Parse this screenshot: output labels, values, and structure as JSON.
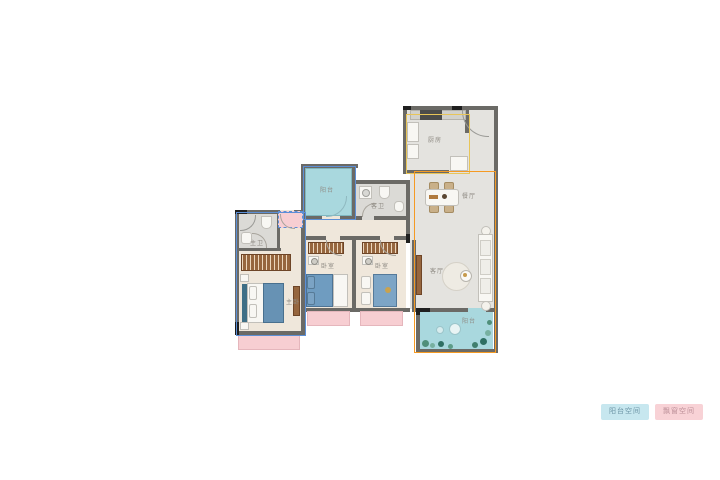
{
  "rooms": {
    "kitchen": {
      "label": "厨房"
    },
    "dining": {
      "label": "餐厅"
    },
    "living": {
      "label": "客厅"
    },
    "balcony_north": {
      "label": "阳台"
    },
    "balcony_south": {
      "label": "阳台"
    },
    "guest_bath": {
      "label": "客卫"
    },
    "master_bath": {
      "label": "主卫"
    },
    "master_bedroom": {
      "label": "主卧"
    },
    "bedroom_a": {
      "label": "卧室"
    },
    "bedroom_b": {
      "label": "卧室"
    }
  },
  "legend": {
    "balcony": {
      "label": "阳台空间"
    },
    "bay": {
      "label": "飘窗空间"
    }
  },
  "colors": {
    "wall": "#6b6a66",
    "wallDark": "#1f1f1f",
    "floorWarm": "#efe7db",
    "floorGray": "#e4e3df",
    "floorTile": "#dbdad6",
    "balcony": "#a9d8de",
    "bay": "#f7ced2",
    "bayBorder": "#e5b6bc",
    "blue": "#5c8fd6",
    "orange": "#f59a23",
    "yellow": "#e8c558",
    "wood": "#96663e",
    "bedBlue": "#6792b4",
    "labelColor": "#8f8b84",
    "legendBlueBg": "#c7e7ef",
    "legendBlueText": "#6b93a4",
    "legendPinkBg": "#f8d2d6",
    "legendPinkText": "#bb8e97"
  }
}
